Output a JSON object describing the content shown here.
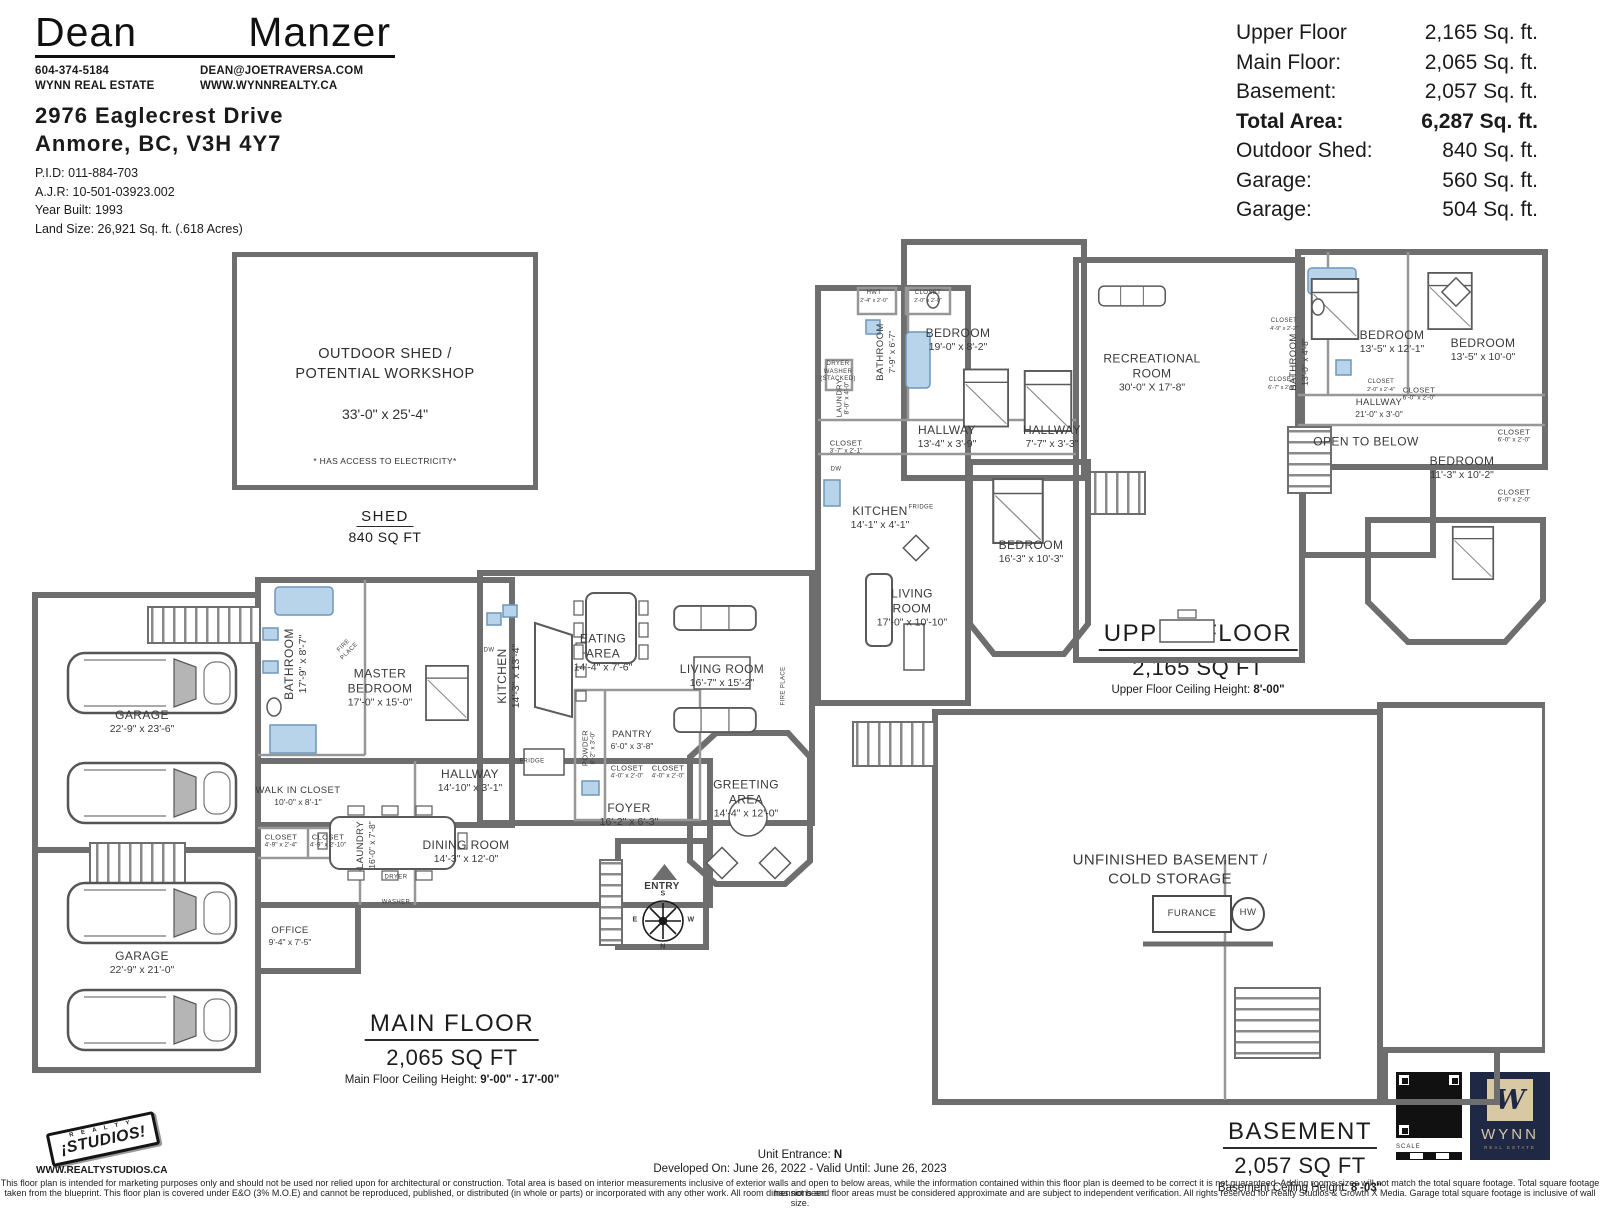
{
  "header": {
    "agent_first": "Dean",
    "agent_last": "Manzer",
    "phone": "604-374-5184",
    "company": "WYNN REAL ESTATE",
    "email": "DEAN@JOETRAVERSA.COM",
    "website": "WWW.WYNNREALTY.CA",
    "address_line1": "2976 Eaglecrest Drive",
    "address_line2": "Anmore, BC, V3H 4Y7",
    "pid": "P.I.D: 011-884-703",
    "ajr": "A.J.R: 10-501-03923.002",
    "year_built": "Year Built: 1993",
    "land_size": "Land Size: 26,921 Sq. ft. (.618 Acres)"
  },
  "area_summary": {
    "rows": [
      {
        "label": "Upper Floor",
        "value": "2,165 Sq. ft."
      },
      {
        "label": "Main Floor:",
        "value": "2,065 Sq. ft."
      },
      {
        "label": "Basement:",
        "value": "2,057 Sq. ft."
      },
      {
        "label": "Total Area:",
        "value": "6,287 Sq. ft."
      },
      {
        "label": "Outdoor Shed:",
        "value": "840 Sq. ft."
      },
      {
        "label": "Garage:",
        "value": "560 Sq. ft."
      },
      {
        "label": "Garage:",
        "value": "504 Sq. ft."
      }
    ]
  },
  "shed": {
    "title": "OUTDOOR SHED /\nPOTENTIAL WORKSHOP",
    "dims": "33'-0\" x 25'-4\"",
    "note": "* HAS ACCESS TO ELECTRICITY*",
    "label": "SHED",
    "sqft": "840 SQ FT"
  },
  "floors": {
    "main": {
      "title": "MAIN FLOOR",
      "sqft": "2,065 SQ FT",
      "ceiling_prefix": "Main Floor Ceiling Height: ",
      "ceiling_value": "9'-00\" - 17'-00\""
    },
    "upper": {
      "title": "UPPER FLOOR",
      "sqft": "2,165 SQ FT",
      "ceiling_prefix": "Upper Floor Ceiling Height: ",
      "ceiling_value": "8'-00\""
    },
    "basement": {
      "title": "BASEMENT",
      "sqft": "2,057 SQ FT",
      "ceiling_prefix": "Basement Ceiling Height: ",
      "ceiling_value": "8'-03\""
    }
  },
  "rooms": {
    "main": [
      {
        "n": "GARAGE",
        "d": "22'-9\" x 23'-6\"",
        "x": 142,
        "y": 722
      },
      {
        "n": "GARAGE",
        "d": "22'-9\" x 21'-0\"",
        "x": 142,
        "y": 963
      },
      {
        "n": "BATHROOM",
        "d": "17'-9\" x 8'-7\"",
        "x": 296,
        "y": 664,
        "r": -90
      },
      {
        "n": "MASTER\nBEDROOM",
        "d": "17'-0\" x 15'-0\"",
        "x": 380,
        "y": 688
      },
      {
        "n": "WALK IN CLOSET",
        "d": "10'-0\" x 8'-1\"",
        "x": 298,
        "y": 796,
        "s": "sm2"
      },
      {
        "n": "CLOSET",
        "d": "4'-9\" x 2'-4\"",
        "x": 281,
        "y": 841,
        "s": "sm"
      },
      {
        "n": "CLOSET",
        "d": "4'-9\" x 2'-10\"",
        "x": 328,
        "y": 841,
        "s": "sm"
      },
      {
        "n": "LAUNDRY",
        "d": "16'-0\" x 7'-8\"",
        "x": 366,
        "y": 845,
        "r": -90,
        "s": "sm2"
      },
      {
        "n": "OFFICE",
        "d": "9'-4\" x 7'-5\"",
        "x": 290,
        "y": 936,
        "s": "sm2"
      },
      {
        "n": "HALLWAY",
        "d": "14'-10\" x 3'-1\"",
        "x": 470,
        "y": 781
      },
      {
        "n": "DINING ROOM",
        "d": "14'-3\" x 12'-0\"",
        "x": 466,
        "y": 852
      },
      {
        "n": "KITCHEN",
        "d": "14'-3\" x 13'-4\"",
        "x": 509,
        "y": 676,
        "r": -90
      },
      {
        "n": "EATING\nAREA",
        "d": "14'-4\" x 7'-6\"",
        "x": 603,
        "y": 653
      },
      {
        "n": "LIVING ROOM",
        "d": "16'-7\" x 15'-2\"",
        "x": 722,
        "y": 676
      },
      {
        "n": "PANTRY",
        "d": "6'-0\" x 3'-8\"",
        "x": 632,
        "y": 740,
        "s": "sm2"
      },
      {
        "n": "POWDER",
        "d": "8'-2\" x 3'-0\"",
        "x": 589,
        "y": 748,
        "r": -90,
        "s": "sm"
      },
      {
        "n": "CLOSET",
        "d": "4'-0\" x 2'-0\"",
        "x": 627,
        "y": 772,
        "s": "sm"
      },
      {
        "n": "CLOSET",
        "d": "4'-0\" x 2'-0\"",
        "x": 668,
        "y": 772,
        "s": "sm"
      },
      {
        "n": "FOYER",
        "d": "16'-2\" x 6'-3\"",
        "x": 629,
        "y": 815
      },
      {
        "n": "GREETING\nAREA",
        "d": "14'-4\" x 12'-0\"",
        "x": 746,
        "y": 799
      },
      {
        "n": "FIRE\nPLACE",
        "x": 347,
        "y": 649,
        "r": -45,
        "s": "xs"
      },
      {
        "n": "FIRE PLACE",
        "x": 784,
        "y": 686,
        "r": -90,
        "s": "xs"
      },
      {
        "n": "FRIDGE",
        "x": 532,
        "y": 762,
        "s": "xs"
      },
      {
        "n": "DW",
        "x": 489,
        "y": 651,
        "s": "xs"
      },
      {
        "n": "DRYER",
        "x": 396,
        "y": 878,
        "s": "xs"
      },
      {
        "n": "WASHER",
        "x": 396,
        "y": 903,
        "s": "xs"
      },
      {
        "n": "ENTRY",
        "x": 662,
        "y": 887,
        "s": "sm2b"
      },
      {
        "n": "S",
        "x": 663,
        "y": 895,
        "s": "xxs"
      },
      {
        "n": "E",
        "x": 635,
        "y": 921,
        "s": "xxs"
      },
      {
        "n": "W",
        "x": 691,
        "y": 921,
        "s": "xxs"
      },
      {
        "n": "N",
        "x": 663,
        "y": 948,
        "s": "xxs"
      }
    ],
    "upper": [
      {
        "n": "HWT",
        "d": "2'-4\" x 2'-0\"",
        "x": 874,
        "y": 297,
        "s": "xs"
      },
      {
        "n": "CLOSET",
        "d": "2'-0\" x 2'-0\"",
        "x": 928,
        "y": 297,
        "s": "xs"
      },
      {
        "n": "BATHROOM",
        "d": "7'-9\" x 6'-7\"",
        "x": 886,
        "y": 352,
        "r": -90,
        "s": "sm2"
      },
      {
        "n": "BEDROOM",
        "d": "19'-0\" x 8'-2\"",
        "x": 958,
        "y": 340
      },
      {
        "n": "LAUNDRY",
        "d": "8'-0\" x 4'-0\"",
        "x": 843,
        "y": 398,
        "r": -90,
        "s": "sm"
      },
      {
        "n": "CLOSET",
        "d": "3'-7\" x 2'-1\"",
        "x": 846,
        "y": 447,
        "s": "sm"
      },
      {
        "n": "DW",
        "x": 836,
        "y": 470,
        "s": "xs"
      },
      {
        "n": "DRYER\nWASHER\n(STACKED)",
        "x": 838,
        "y": 372,
        "s": "xs"
      },
      {
        "n": "HALLWAY",
        "d": "13'-4\" x 3'-9\"",
        "x": 947,
        "y": 437
      },
      {
        "n": "HALLWAY",
        "d": "7'-7\" x 3'-3\"",
        "x": 1052,
        "y": 437
      },
      {
        "n": "KITCHEN",
        "d": "14'-1\" x 4'-1\"",
        "x": 880,
        "y": 518
      },
      {
        "n": "FRIDGE",
        "x": 921,
        "y": 508,
        "s": "xs"
      },
      {
        "n": "LIVING\nROOM",
        "d": "17'-0\" x 10'-10\"",
        "x": 912,
        "y": 608
      },
      {
        "n": "BEDROOM",
        "d": "16'-3\" x 10'-3\"",
        "x": 1031,
        "y": 552
      },
      {
        "n": "RECREATIONAL\nROOM",
        "d": "30'-0\" X 17'-8\"",
        "x": 1152,
        "y": 373
      },
      {
        "n": "CLOSET",
        "d": "4'-9\" x 2'-2\"",
        "x": 1284,
        "y": 325,
        "s": "xs"
      },
      {
        "n": "CLOSET",
        "d": "6'-7\" x 2'-0\"",
        "x": 1282,
        "y": 384,
        "s": "xs"
      },
      {
        "n": "BATHROOM",
        "d": "13'-0\" x 4'-8\"",
        "x": 1299,
        "y": 362,
        "r": -90,
        "s": "sm2"
      },
      {
        "n": "CLOSET",
        "d": "2'-0\" x 2'-4\"",
        "x": 1381,
        "y": 386,
        "s": "xs"
      },
      {
        "n": "BEDROOM",
        "d": "13'-5\" x 12'-1\"",
        "x": 1392,
        "y": 342
      },
      {
        "n": "CLOSET",
        "d": "6'-0\" x 2'-0\"",
        "x": 1419,
        "y": 394,
        "s": "sm"
      },
      {
        "n": "BEDROOM",
        "d": "13'-5\" x 10'-0\"",
        "x": 1483,
        "y": 350
      },
      {
        "n": "CLOSET",
        "d": "6'-0\" x 2'-0\"",
        "x": 1514,
        "y": 436,
        "s": "sm"
      },
      {
        "n": "CLOSET",
        "d": "6'-0\" x 2'-0\"",
        "x": 1514,
        "y": 496,
        "s": "sm"
      },
      {
        "n": "HALLWAY",
        "d": "21'-0\" x 3'-0\"",
        "x": 1379,
        "y": 408,
        "s": "sm2"
      },
      {
        "n": "OPEN TO BELOW",
        "x": 1366,
        "y": 442
      },
      {
        "n": "BEDROOM",
        "d": "11'-3\" x 10'-2\"",
        "x": 1462,
        "y": 468
      }
    ],
    "basement": [
      {
        "n": "UNFINISHED BASEMENT /\nCOLD STORAGE",
        "x": 1170,
        "y": 870,
        "s": "lg"
      },
      {
        "n": "FURANCE",
        "x": 1192,
        "y": 914,
        "s": "sm2"
      },
      {
        "n": "HW",
        "x": 1248,
        "y": 913,
        "s": "sm2"
      }
    ]
  },
  "footer": {
    "unit_entrance_prefix": "Unit Entrance: ",
    "unit_entrance_value": "N",
    "developed": "Developed On: June 26, 2022 - Valid Until: June 26, 2023",
    "disclaimer_line1": "This floor plan is intended for marketing purposes only and should not be used nor relied upon for architectural or construction. Total area is based on interior measurements inclusive of exterior walls and open to below areas, while the information contained within this floor plan is deemed to be correct it is not guaranteed. Adding rooms sizes will not match the total square footage. Total square footage has not been",
    "disclaimer_line2": "taken from the blueprint. This floor plan is covered under E&O (3% M.O.E) and cannot be reproduced, published, or distributed (in whole or parts) or incorporated with any other work. All room dimensions and floor areas must be considered approximate and are subject to independent verification. All rights reserved for Realty Studios & Growth X Media. Garage total square footage is inclusive of wall size.",
    "scale_label": "SCALE"
  },
  "logos": {
    "studios_top": "R E A L T Y",
    "studios_name": "¡STUDIOS!",
    "studios_url": "WWW.REALTYSTUDIOS.CA",
    "wynn_monogram": "W",
    "wynn_name": "WYNN",
    "wynn_sub": "REAL ESTATE"
  },
  "colors": {
    "wall_gray": "#6e6e6e",
    "fixture_blue": "#b8d4ea",
    "wynn_navy": "#1f2845",
    "wynn_gold": "#d8c9a4"
  }
}
